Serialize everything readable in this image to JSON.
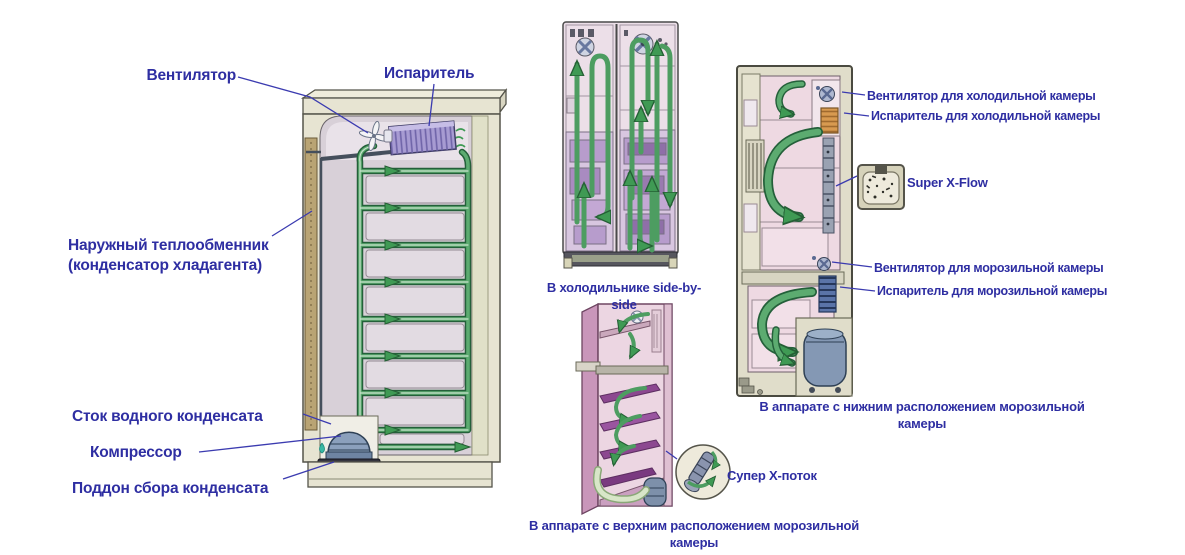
{
  "colors": {
    "label_blue": "#2e2ea2",
    "leader_blue": "#3b3bb0",
    "flow_green": "#4d9d61",
    "cabinet_beige": "#e7e4d2",
    "interior_lavender": "#d8d0d8"
  },
  "left_diagram": {
    "labels": {
      "fan": "Вентилятор",
      "evaporator": "Испаритель",
      "heat_exchanger": "Наружный теплообменник\n(конденсатор хладагента)",
      "drain": "Сток водного конденсата",
      "compressor": "Компрессор",
      "drip_tray": "Поддон сбора конденсата"
    }
  },
  "sbs_diagram": {
    "caption": "В холодильнике side-by-side"
  },
  "top_freezer_diagram": {
    "caption": "В аппарате с верхним расположением морозильной камеры",
    "inset_label": "Супер X-поток"
  },
  "bottom_freezer_diagram": {
    "caption": "В аппарате с нижним расположением морозильной камеры",
    "labels": {
      "fridge_fan": "Вентилятор для холодильной камеры",
      "fridge_evaporator": "Испаритель для холодильной камеры",
      "super_x_flow": "Super X-Flow",
      "freezer_fan": "Вентилятор для морозильной камеры",
      "freezer_evaporator": "Испаритель для морозильной камеры"
    }
  }
}
